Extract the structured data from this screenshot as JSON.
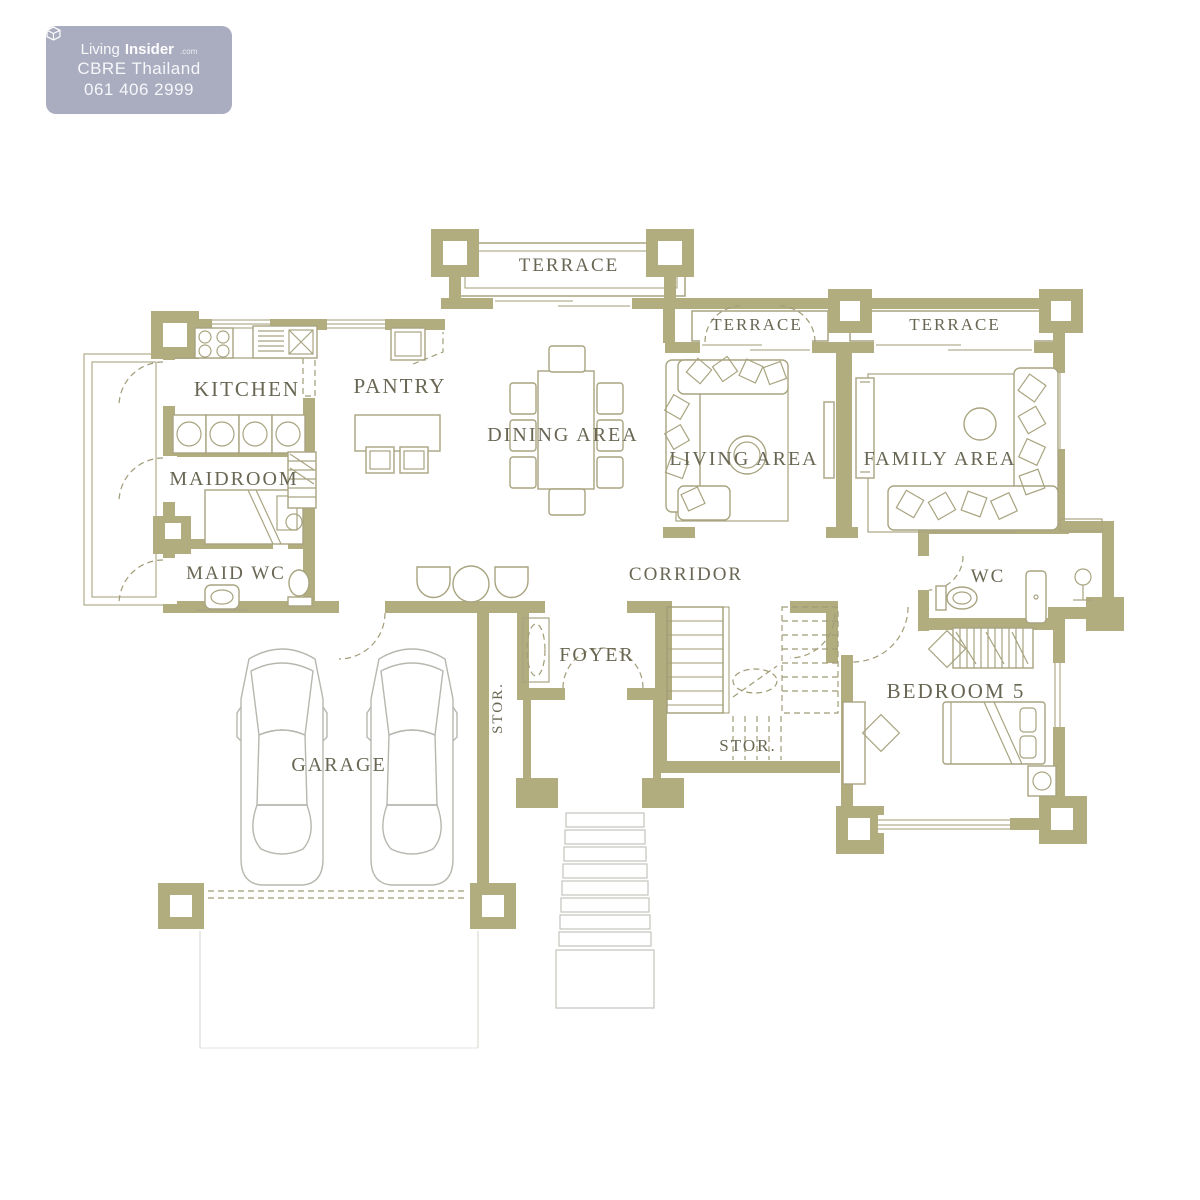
{
  "watermark": {
    "brand": "Living",
    "brand_bold": "Insider",
    "brand_suffix": ".com",
    "line2": "CBRE Thailand",
    "phone": "061 406 2999"
  },
  "rooms": {
    "terrace_top": "TERRACE",
    "terrace_living": "TERRACE",
    "terrace_family": "TERRACE",
    "kitchen": "KITCHEN",
    "pantry": "PANTRY",
    "dining": "DINING AREA",
    "living": "LIVING AREA",
    "family": "FAMILY AREA",
    "maidroom": "MAIDROOM",
    "maid_wc": "MAID WC",
    "corridor": "CORRIDOR",
    "wc": "WC",
    "foyer": "FOYER",
    "stor_side": "STOR.",
    "garage": "GARAGE",
    "stor_stairs": "STOR.",
    "bedroom5": "BEDROOM 5"
  },
  "colors": {
    "wall": "#b2ad7f",
    "line": "#a19c77",
    "furn": "#a8a480",
    "car": "#b6b8af",
    "label": "#696753",
    "badge_bg": "#a7a9bd",
    "badge_text": "#fdfdff"
  }
}
